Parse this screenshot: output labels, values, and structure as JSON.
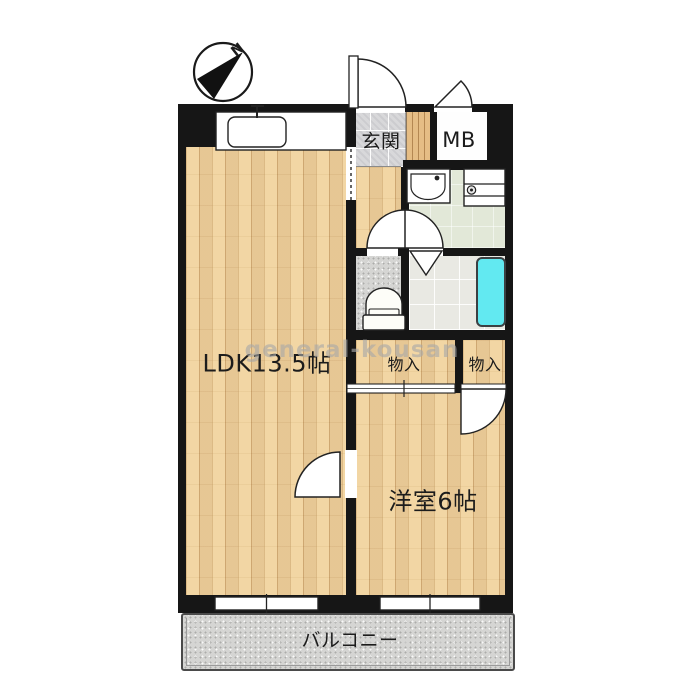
{
  "compass": {
    "north_label": "N"
  },
  "watermark": {
    "text": "general-kousan"
  },
  "rooms": {
    "ldk": {
      "label": "LDK13.5帖"
    },
    "entrance": {
      "label": "玄関"
    },
    "meter_box": {
      "label": "MB"
    },
    "storage_left": {
      "label": "物入"
    },
    "storage_right": {
      "label": "物入"
    },
    "western_room": {
      "label": "洋室6帖"
    },
    "balcony": {
      "label": "バルコニー"
    }
  },
  "colors": {
    "wall": "#161616",
    "wood_floor": "#edd1a2",
    "entrance_step_wood": "#e5bd85",
    "entrance_tile": "#d8d8da",
    "washroom_floor": "#e2e8d8",
    "toilet_floor": "#d5d5d3",
    "bathroom_tile": "#e9e9e3",
    "bathtub": "#62e9f1",
    "balcony_floor": "#d6d6d4",
    "watermark_gray": "#a8a8a8"
  }
}
